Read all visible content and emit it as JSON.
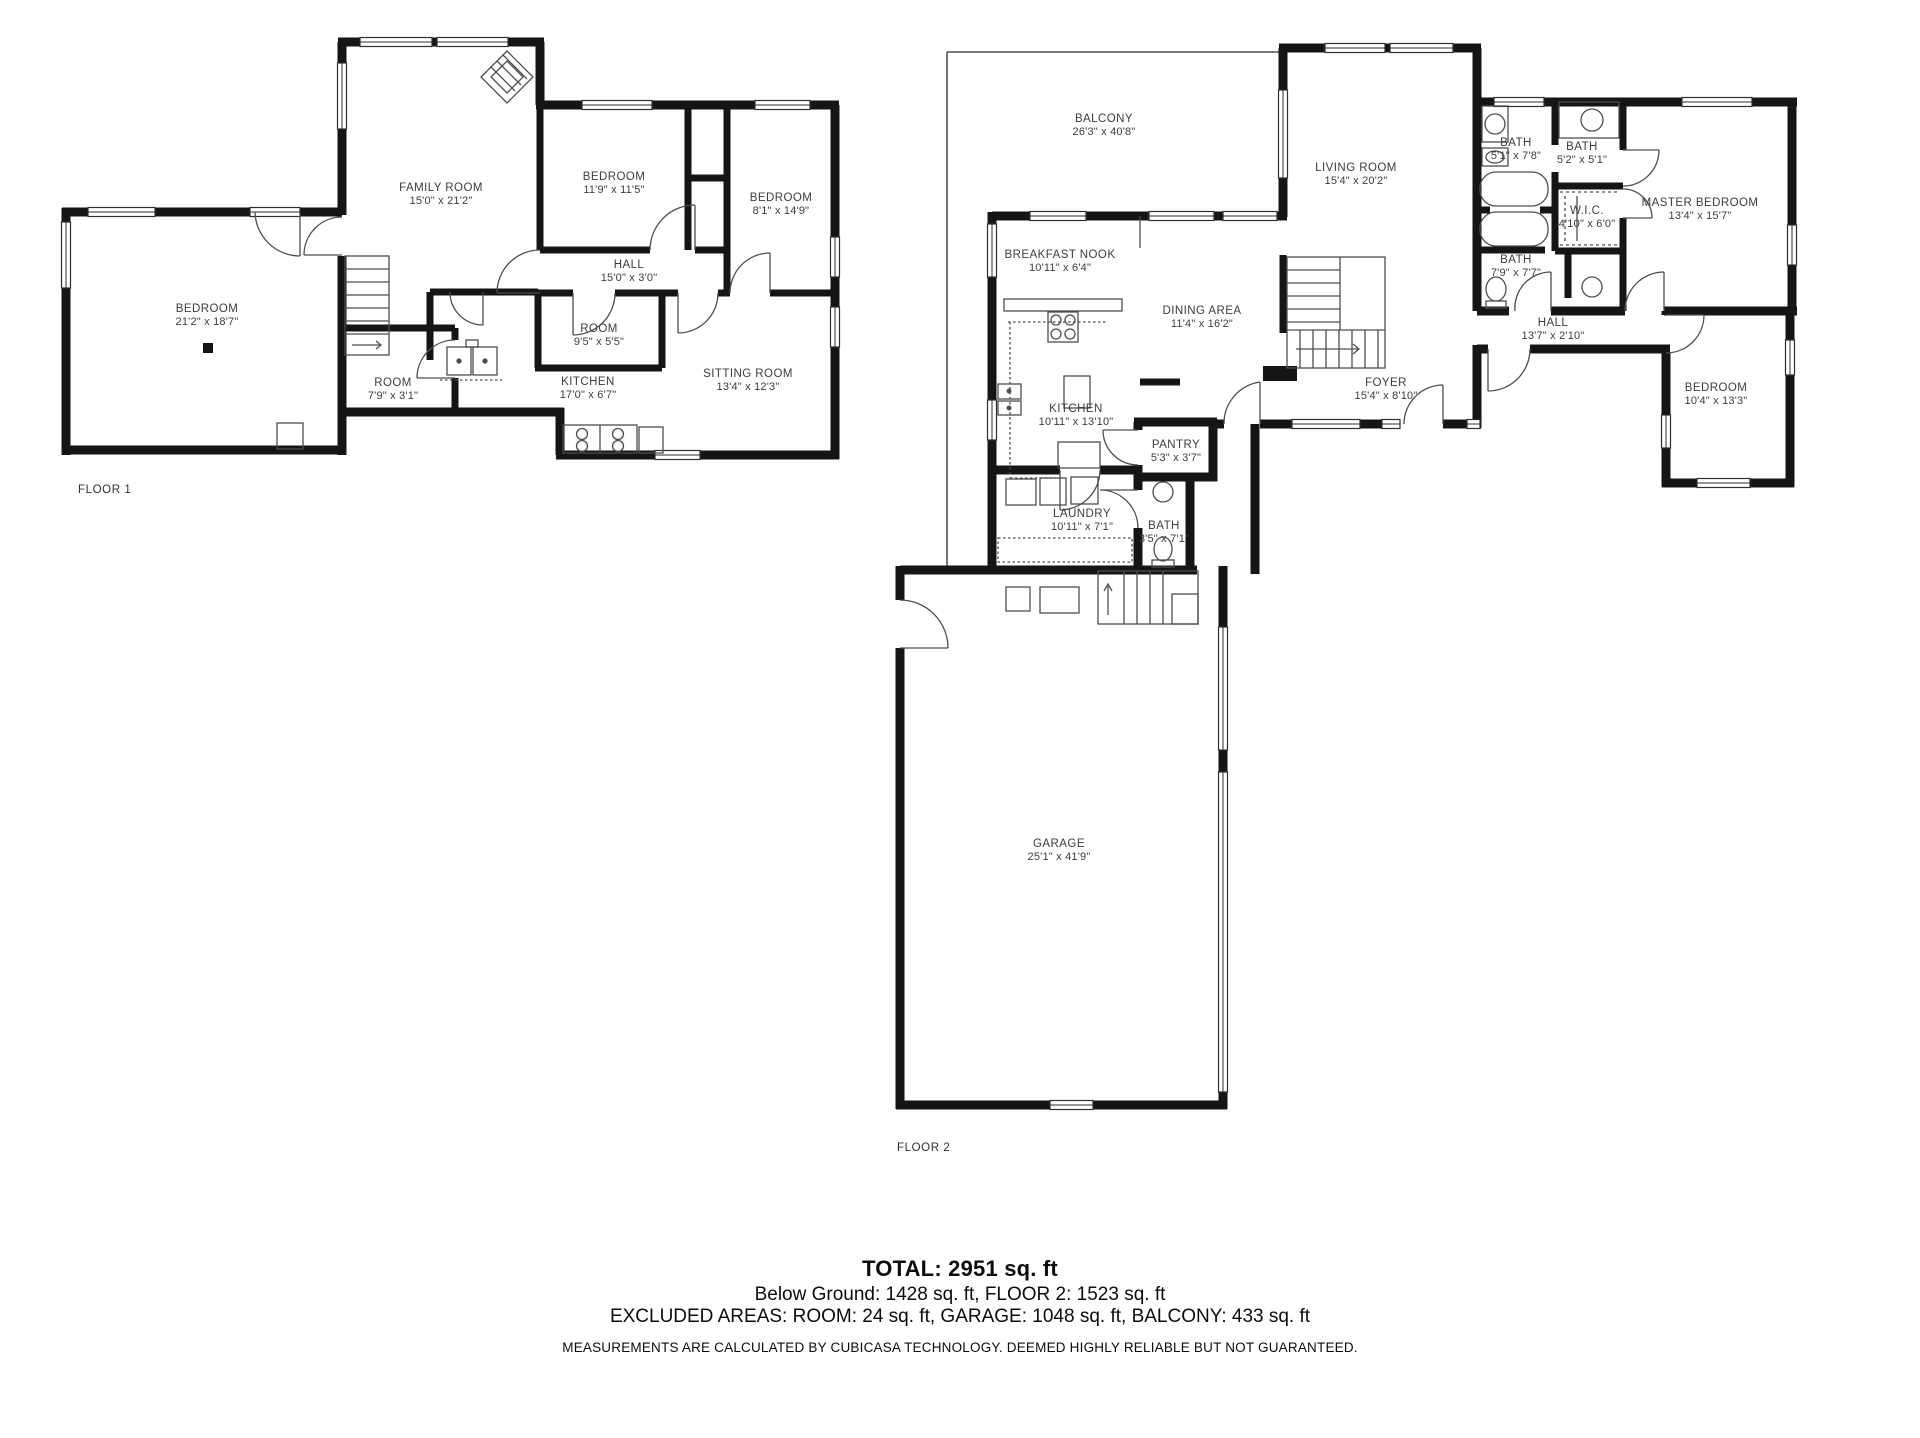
{
  "palette": {
    "background": "#ffffff",
    "wall": "#151515",
    "thin_line": "#4d4d4d",
    "label": "#3c3c3c",
    "text": "#0c0c0c"
  },
  "floor1": {
    "tag": "FLOOR 1",
    "rooms": {
      "bedroom_main": {
        "name": "BEDROOM",
        "dims": "21'2\" x 18'7\""
      },
      "family_room": {
        "name": "FAMILY ROOM",
        "dims": "15'0\" x 21'2\""
      },
      "bedroom_2": {
        "name": "BEDROOM",
        "dims": "11'9\" x 11'5\""
      },
      "bedroom_3": {
        "name": "BEDROOM",
        "dims": "8'1\" x 14'9\""
      },
      "hall": {
        "name": "HALL",
        "dims": "15'0\" x 3'0\""
      },
      "room_small": {
        "name": "ROOM",
        "dims": "9'5\" x 5'5\""
      },
      "kitchen": {
        "name": "KITCHEN",
        "dims": "17'0\" x 6'7\""
      },
      "room_side": {
        "name": "ROOM",
        "dims": "7'9\" x 3'1\""
      },
      "sitting_room": {
        "name": "SITTING ROOM",
        "dims": "13'4\" x 12'3\""
      }
    }
  },
  "floor2": {
    "tag": "FLOOR 2",
    "rooms": {
      "balcony": {
        "name": "BALCONY",
        "dims": "26'3\" x 40'8\""
      },
      "living_room": {
        "name": "LIVING ROOM",
        "dims": "15'4\" x 20'2\""
      },
      "bath_1": {
        "name": "BATH",
        "dims": "5'1\" x 7'8\""
      },
      "bath_2": {
        "name": "BATH",
        "dims": "5'2\" x 5'1\""
      },
      "wic": {
        "name": "W.I.C.",
        "dims": "4'10\" x 6'0\""
      },
      "master_bedroom": {
        "name": "MASTER BEDROOM",
        "dims": "13'4\" x 15'7\""
      },
      "breakfast_nook": {
        "name": "BREAKFAST NOOK",
        "dims": "10'11\" x 6'4\""
      },
      "dining_area": {
        "name": "DINING AREA",
        "dims": "11'4\" x 16'2\""
      },
      "bath_3": {
        "name": "BATH",
        "dims": "7'9\" x 7'7\""
      },
      "hall": {
        "name": "HALL",
        "dims": "13'7\" x 2'10\""
      },
      "kitchen": {
        "name": "KITCHEN",
        "dims": "10'11\" x 13'10\""
      },
      "foyer": {
        "name": "FOYER",
        "dims": "15'4\" x 8'10\""
      },
      "bedroom": {
        "name": "BEDROOM",
        "dims": "10'4\" x 13'3\""
      },
      "pantry": {
        "name": "PANTRY",
        "dims": "5'3\" x 3'7\""
      },
      "laundry": {
        "name": "LAUNDRY",
        "dims": "10'11\" x 7'1\""
      },
      "bath_4": {
        "name": "BATH",
        "dims": "3'5\" x 7'1\""
      },
      "garage": {
        "name": "GARAGE",
        "dims": "25'1\" x 41'9\""
      }
    }
  },
  "summary": {
    "total": "TOTAL: 2951 sq. ft",
    "breakdown": "Below Ground: 1428 sq. ft, FLOOR 2: 1523 sq. ft",
    "excluded": "EXCLUDED AREAS: ROOM: 24 sq. ft, GARAGE: 1048 sq. ft, BALCONY: 433 sq. ft",
    "disclaimer": "MEASUREMENTS ARE CALCULATED BY CUBICASA TECHNOLOGY. DEEMED HIGHLY RELIABLE BUT NOT GUARANTEED."
  }
}
